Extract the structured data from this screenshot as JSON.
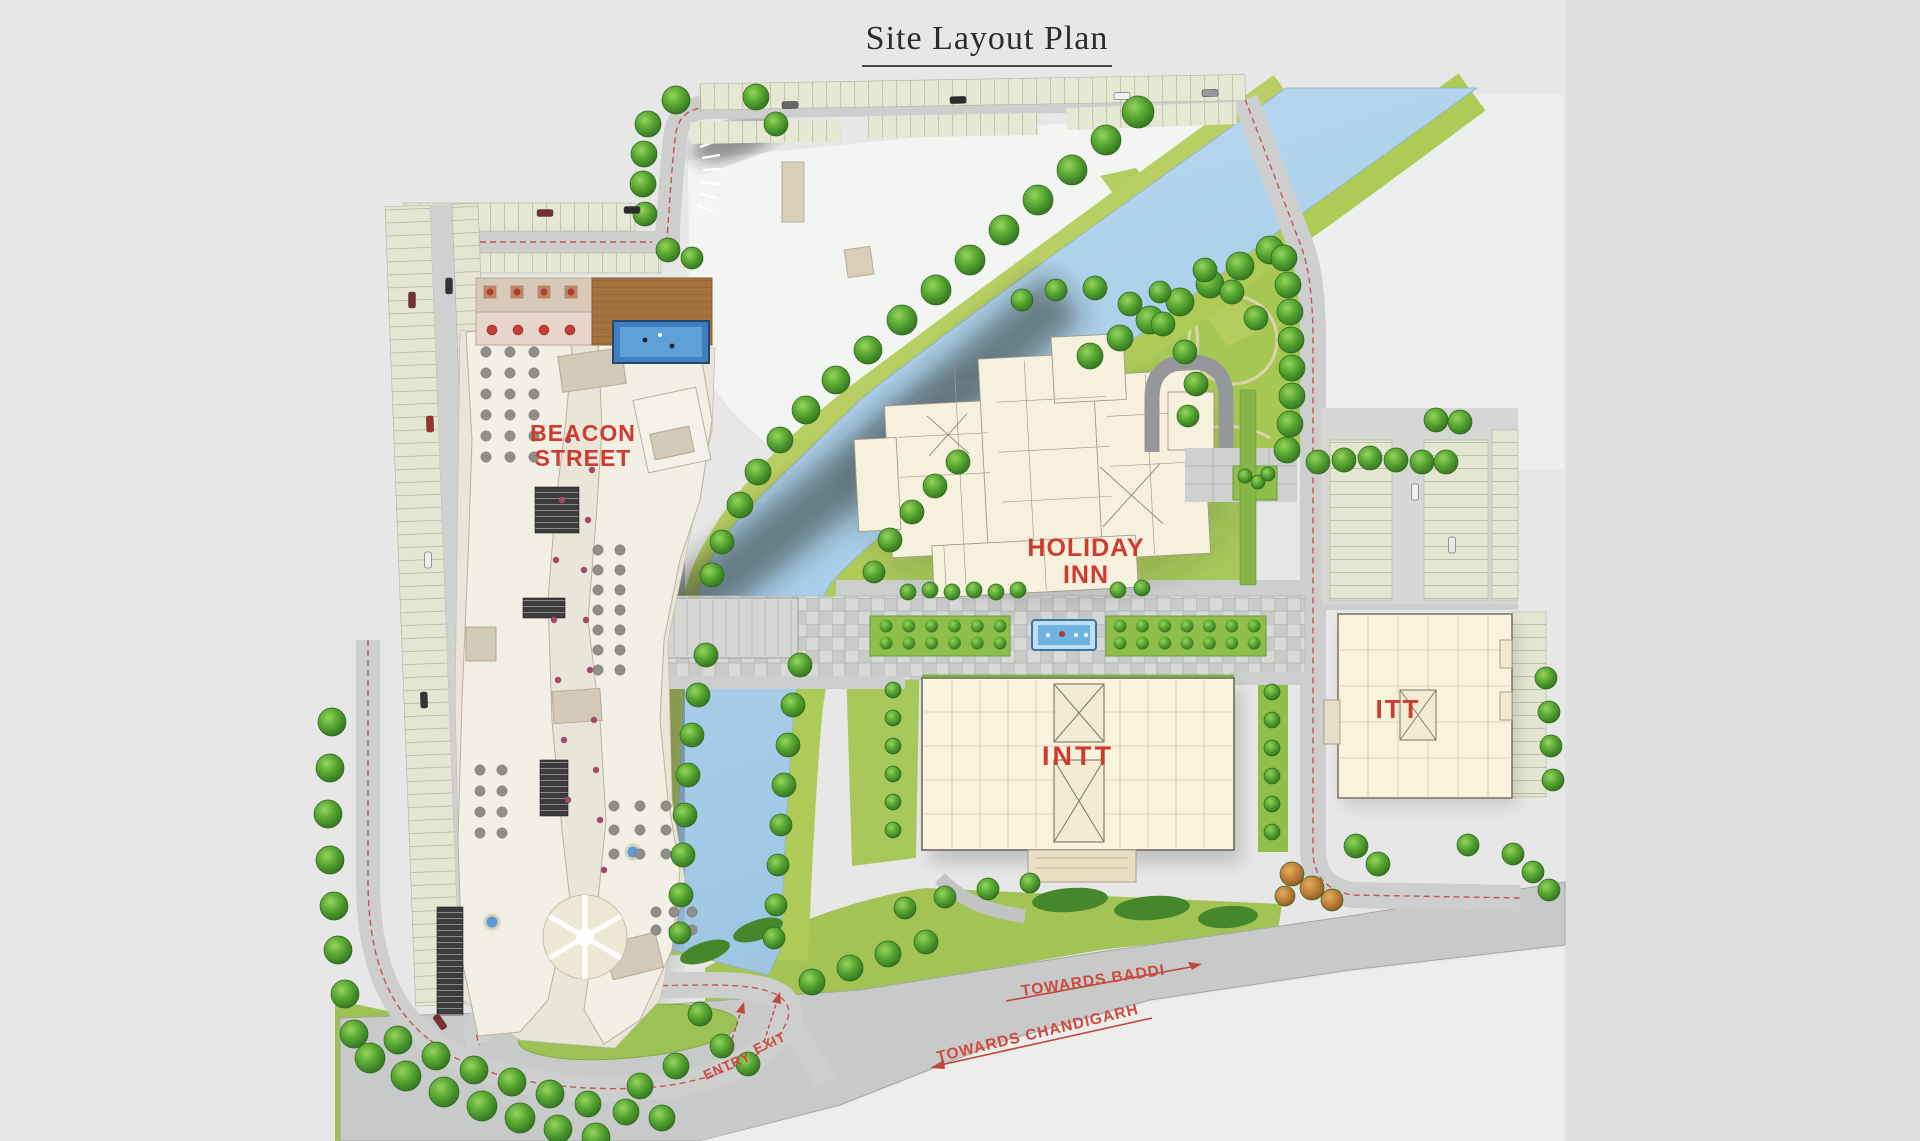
{
  "title": "Site Layout Plan",
  "labels": {
    "beacon_line1": "BEACON",
    "beacon_line2": "STREET",
    "holiday_line1": "HOLIDAY",
    "holiday_line2": "INN",
    "intt": "INTT",
    "itt": "ITT",
    "towards_baddi": "TOWARDS BADDI",
    "towards_chandigarh": "TOWARDS CHANDIGARH",
    "entry": "ENTRY",
    "exit": "EXIT"
  },
  "colors": {
    "background": "#e6e7e6",
    "label_red": "#cf3a31",
    "road_dash_red": "#c0493f",
    "water": "#aed2ec",
    "lawn": "#a6c755",
    "road": "#cdcfce",
    "building_cream": "#f7f2dd",
    "tree_green": "#4d9a2e",
    "pool_blue": "#3f7fc1"
  }
}
